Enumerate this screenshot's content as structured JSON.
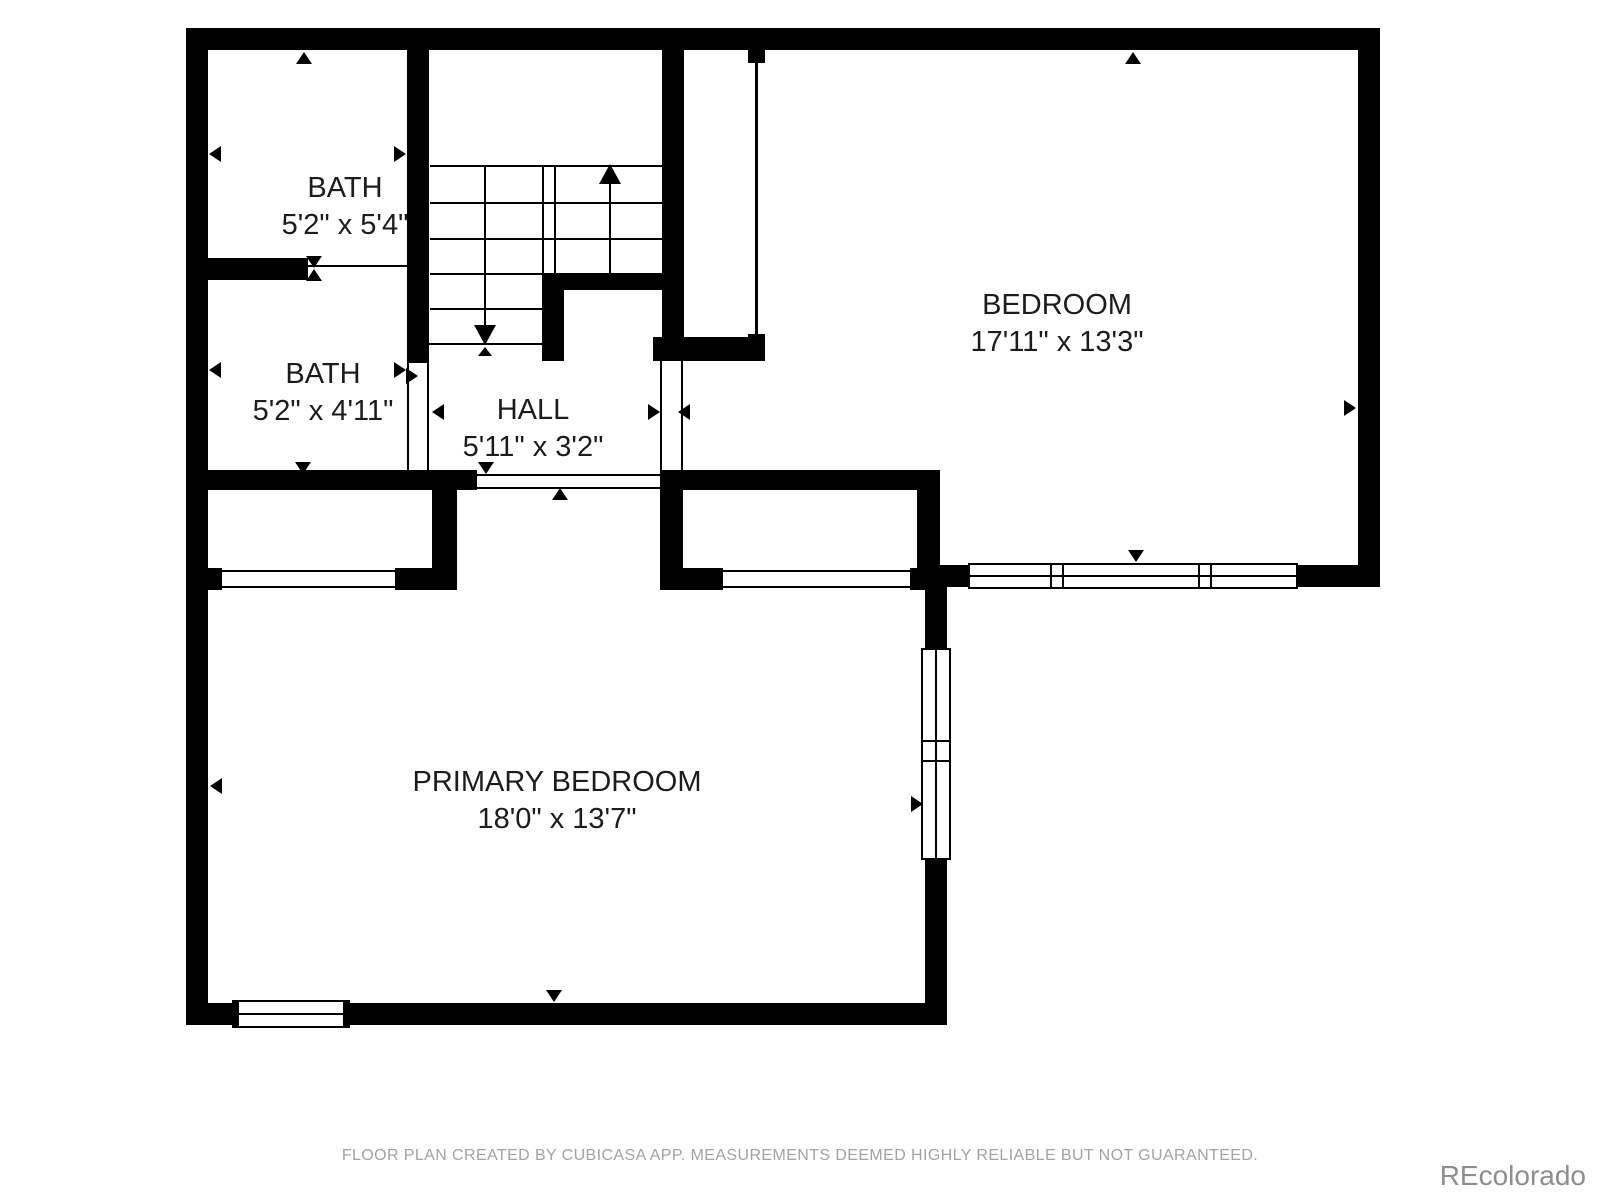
{
  "rooms": {
    "bath_top": {
      "name": "BATH",
      "dims": "5'2\" x 5'4\""
    },
    "bath_lower": {
      "name": "BATH",
      "dims": "5'2\" x 4'11\""
    },
    "hall": {
      "name": "HALL",
      "dims": "5'11\" x 3'2\""
    },
    "bedroom": {
      "name": "BEDROOM",
      "dims": "17'11\" x 13'3\""
    },
    "primary_bedroom": {
      "name": "PRIMARY BEDROOM",
      "dims": "18'0\" x 13'7\""
    }
  },
  "footer": {
    "disclaimer": "FLOOR PLAN CREATED BY CUBICASA APP. MEASUREMENTS DEEMED HIGHLY RELIABLE BUT NOT GUARANTEED."
  },
  "watermark": {
    "text": "REcolorado"
  },
  "colors": {
    "wall": "#000000",
    "label_text": "#1c1c1c",
    "footer_text": "#a3a3a3",
    "watermark_text": "#8e8e8e"
  }
}
